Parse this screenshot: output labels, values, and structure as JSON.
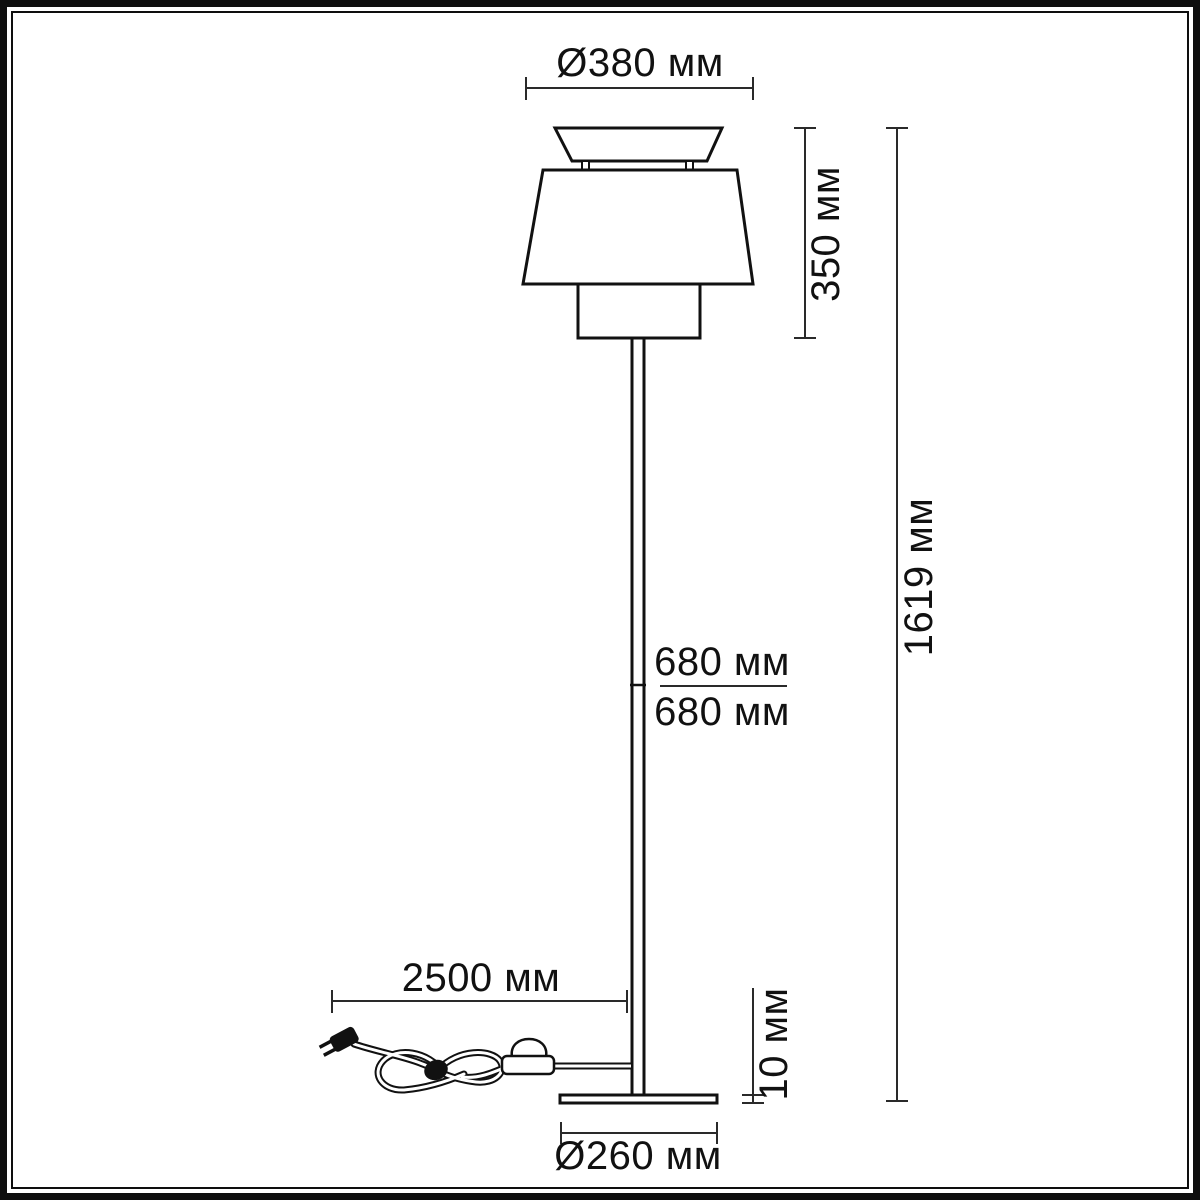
{
  "diagram": {
    "type": "technical-dimension-drawing",
    "subject": "floor-lamp",
    "unit": "мм",
    "colors": {
      "line": "#111111",
      "dimension_line": "#2a2a2a",
      "background": "#ffffff"
    },
    "dimensions": {
      "shade_diameter": {
        "label": "Ø380 мм",
        "value": 380
      },
      "shade_height": {
        "label": "350 мм",
        "value": 350
      },
      "total_height": {
        "label": "1619 мм",
        "value": 1619
      },
      "stem_upper": {
        "label": "680 мм",
        "value": 680
      },
      "stem_lower": {
        "label": "680 мм",
        "value": 680
      },
      "cord_length": {
        "label": "2500 мм",
        "value": 2500
      },
      "base_thickness": {
        "label": "10 мм",
        "value": 10
      },
      "base_diameter": {
        "label": "Ø260 мм",
        "value": 260
      }
    }
  }
}
